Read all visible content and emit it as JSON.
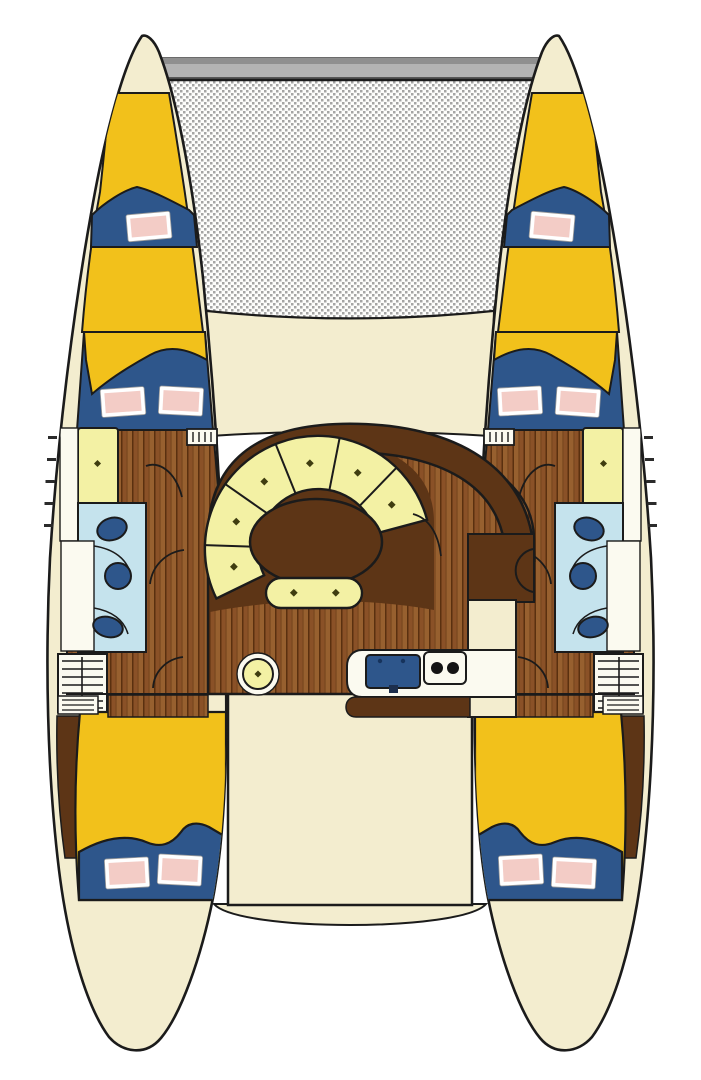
{
  "title": "Catamaran yacht interior deck plan (top view)",
  "document_type": "boat floor plan diagram",
  "visible_text": [],
  "palette": {
    "background": "#ffffff",
    "outline": "#1b1b1b",
    "hull_cream": "#f3edcf",
    "beam_gray": "#b3b3b3",
    "beam_gray_dark": "#8f8f8f",
    "mesh_dot": "#8f8f8f",
    "mesh_bg": "#fdfdfb",
    "bed_yellow": "#f2c11b",
    "bed_blue": "#2e568b",
    "pillow_pink": "#f3ccc6",
    "pillow_white": "#ffffff",
    "wood_brown": "#8a5127",
    "wood_brown_light": "#97602f",
    "wood_seam": "#5a300f",
    "dark_brown": "#5d3516",
    "pale_cushion": "#f3f1a4",
    "bath_blue": "#c5e3ed",
    "fixture_blue": "#2e568b",
    "counter_white": "#fbfaf0",
    "burner_black": "#141414",
    "button_olive": "#3f3d10"
  },
  "areas": {
    "crossbeam": "forward aluminium crossbeam",
    "trampoline": "bow trampoline net",
    "foredeck": "foredeck between hulls",
    "port_bow_berth": "port bow V-berth with pillow",
    "starboard_bow_berth": "starboard bow V-berth with pillow",
    "port_forward_cabin": "port forward double cabin",
    "starboard_forward_cabin": "starboard forward double cabin",
    "port_head": "port head (bathroom) with toilet, sink and shower",
    "starboard_head": "starboard head (bathroom)",
    "salon": "main salon with curved dinette settee",
    "dinette_table": "oval dinette table",
    "settee_bench": "dinette bench seat",
    "footstool": "round footstool",
    "galley": "galley with double sink and two-burner stove",
    "cockpit": "aft cockpit",
    "swim_platform": "transom swim step",
    "port_aft_cabin": "port aft double cabin",
    "starboard_aft_cabin": "starboard aft double cabin",
    "companionway_ladders": "companionway steps into hulls"
  }
}
